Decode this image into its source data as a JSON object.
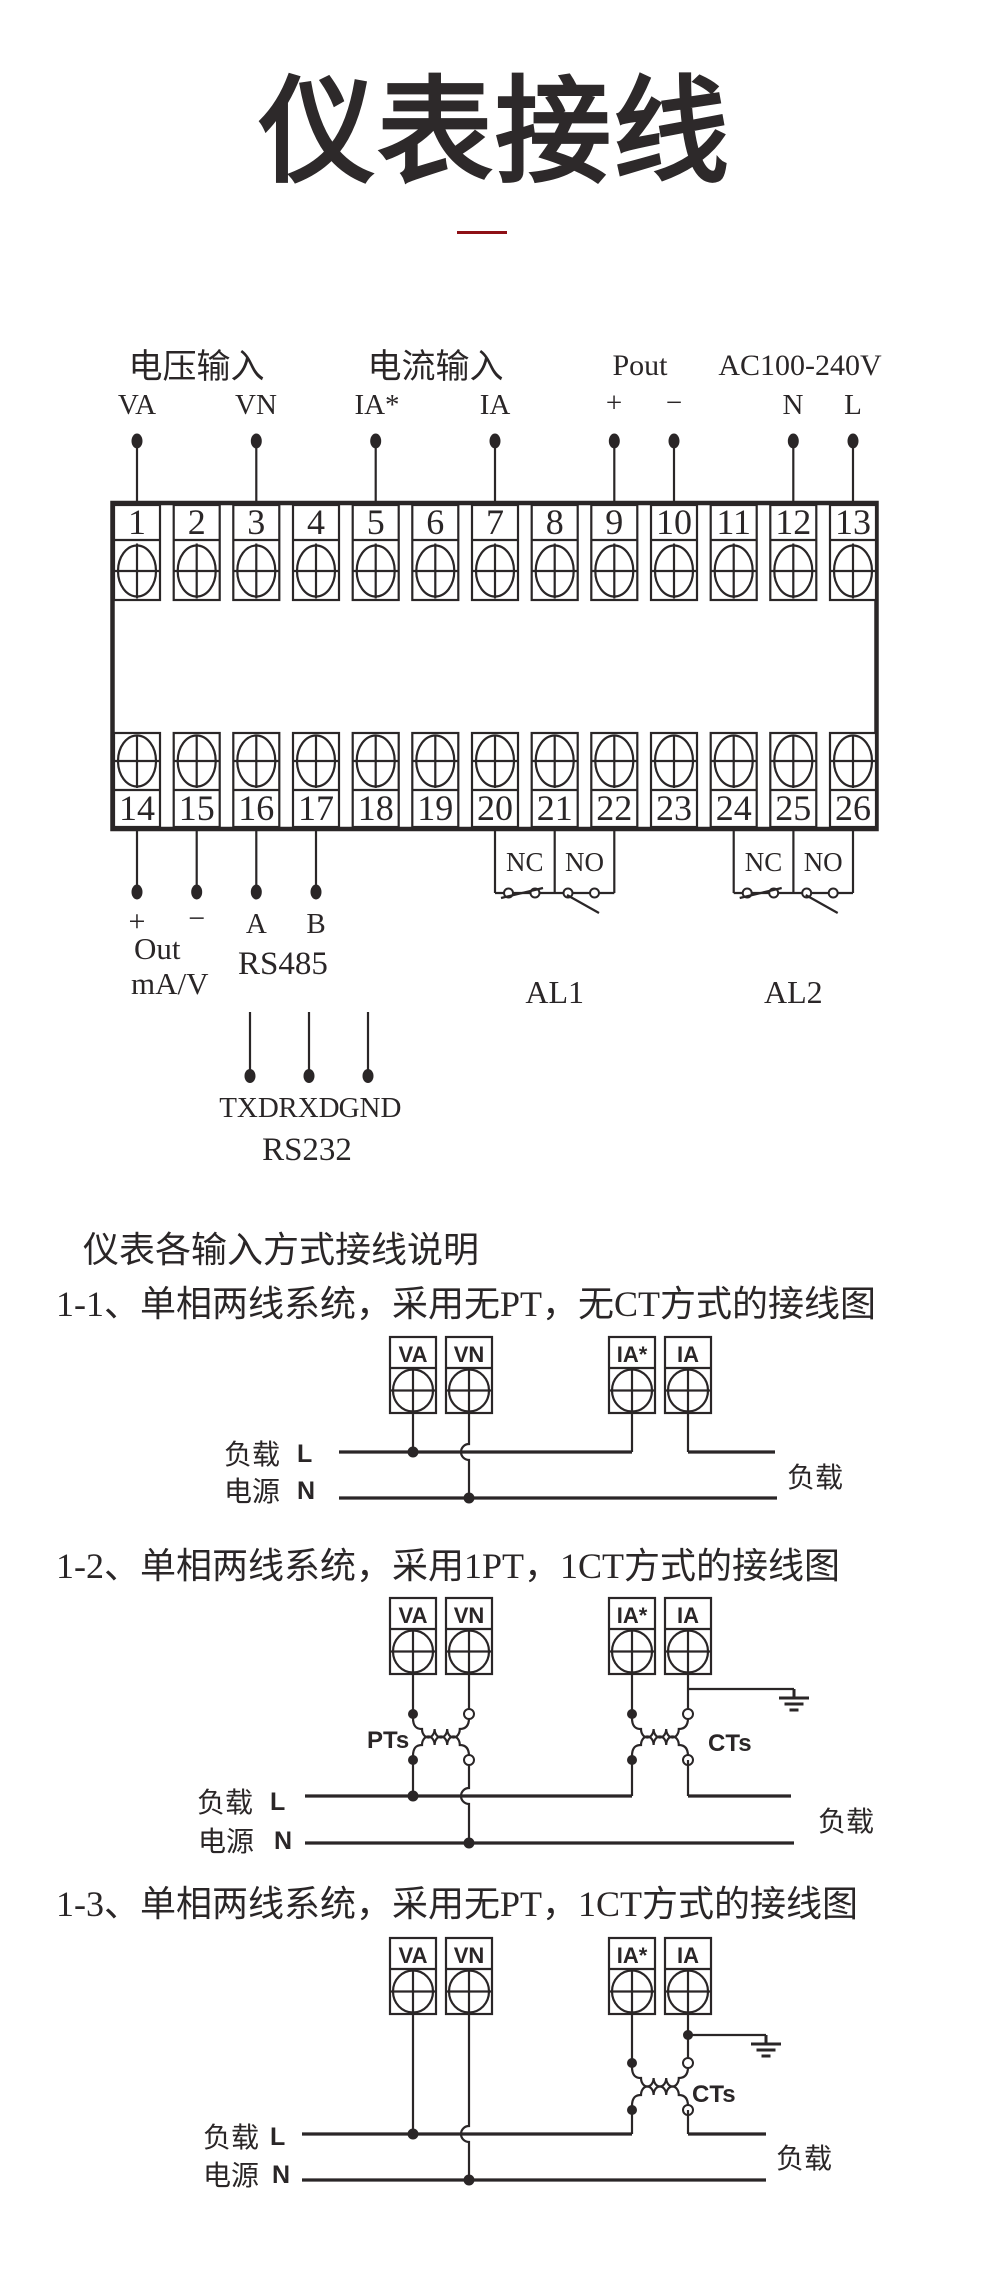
{
  "title": "仪表接线",
  "colors": {
    "ink": "#2a2627",
    "accent": "#8e1016"
  },
  "main": {
    "groups": [
      "电压输入",
      "电流输入",
      "Pout",
      "AC100-240V"
    ],
    "pins": [
      "VA",
      "VN",
      "IA*",
      "IA",
      "+",
      "−",
      "N",
      "L"
    ],
    "top_terminals": [
      "1",
      "2",
      "3",
      "4",
      "5",
      "6",
      "7",
      "8",
      "9",
      "10",
      "11",
      "12",
      "13"
    ],
    "bottom_terminals": [
      "14",
      "15",
      "16",
      "17",
      "18",
      "19",
      "20",
      "21",
      "22",
      "23",
      "24",
      "25",
      "26"
    ],
    "analog_out": {
      "plus": "+",
      "minus": "−",
      "line1": "Out",
      "line2": "mA/V"
    },
    "rs485": {
      "a": "A",
      "b": "B",
      "label": "RS485"
    },
    "relay1": {
      "nc": "NC",
      "no": "NO",
      "label": "AL1"
    },
    "relay2": {
      "nc": "NC",
      "no": "NO",
      "label": "AL2"
    },
    "rs232": {
      "txd": "TXD",
      "rxd": "RXD",
      "gnd": "GND",
      "label": "RS232"
    }
  },
  "notes": {
    "intro": "仪表各输入方式接线说明"
  },
  "diagrams": [
    {
      "heading": "1-1、单相两线系统，采用无PT，无CT方式的接线图",
      "terminals": [
        "VA",
        "VN",
        "IA*",
        "IA"
      ],
      "labels": {
        "load_left": "负载",
        "source_left": "电源",
        "line_l": "L",
        "line_n": "N",
        "load_right": "负载"
      }
    },
    {
      "heading": "1-2、单相两线系统，采用1PT，1CT方式的接线图",
      "terminals": [
        "VA",
        "VN",
        "IA*",
        "IA"
      ],
      "transformers": {
        "pt": "PTs",
        "ct": "CTs"
      },
      "labels": {
        "load_left": "负载",
        "source_left": "电源",
        "line_l": "L",
        "line_n": "N",
        "load_right": "负载"
      }
    },
    {
      "heading": "1-3、单相两线系统，采用无PT，1CT方式的接线图",
      "terminals": [
        "VA",
        "VN",
        "IA*",
        "IA"
      ],
      "transformers": {
        "ct": "CTs"
      },
      "labels": {
        "load_left": "负载",
        "source_left": "电源",
        "line_l": "L",
        "line_n": "N",
        "load_right": "负载"
      }
    }
  ]
}
